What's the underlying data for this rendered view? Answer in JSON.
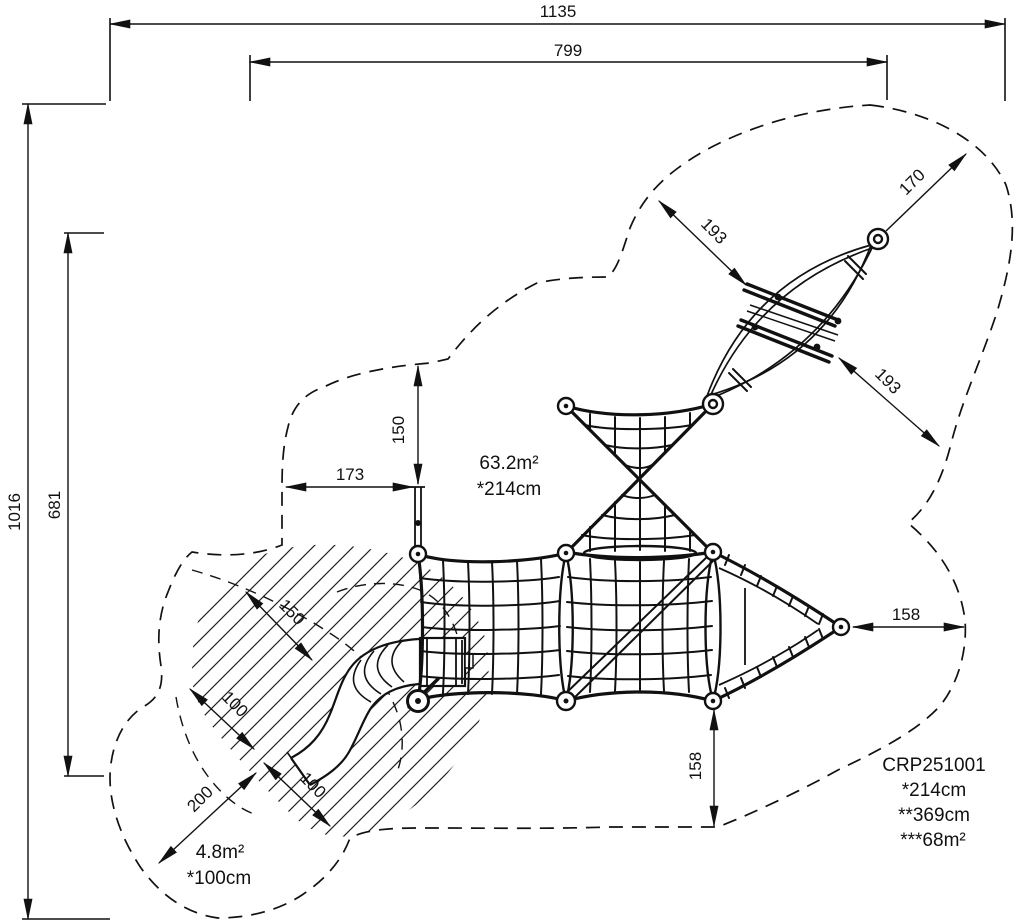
{
  "dims": {
    "overall_width": "1135",
    "inner_width": "799",
    "overall_height": "1016",
    "inner_height": "681",
    "post_top_clearance": "150",
    "post_side_clearance": "173",
    "leaf_upper_clearance": "193",
    "leaf_top_clearance": "170",
    "leaf_lower_clearance": "193",
    "apex_side_clearance": "158",
    "apex_bottom_clearance": "158",
    "slide_side_clearance": "150",
    "slide_upper_clearance": "100",
    "slide_runout_length": "200",
    "slide_runout_width": "100"
  },
  "areas": {
    "main": {
      "value": "63.2m²",
      "note": "*214cm"
    },
    "slide": {
      "value": "4.8m²",
      "note": "*100cm"
    }
  },
  "legend": {
    "product_code": "CRP251001",
    "note1": "*214cm",
    "note2": "**369cm",
    "note3": "***68m²"
  },
  "colors": {
    "line": "#111111",
    "background": "#ffffff"
  }
}
